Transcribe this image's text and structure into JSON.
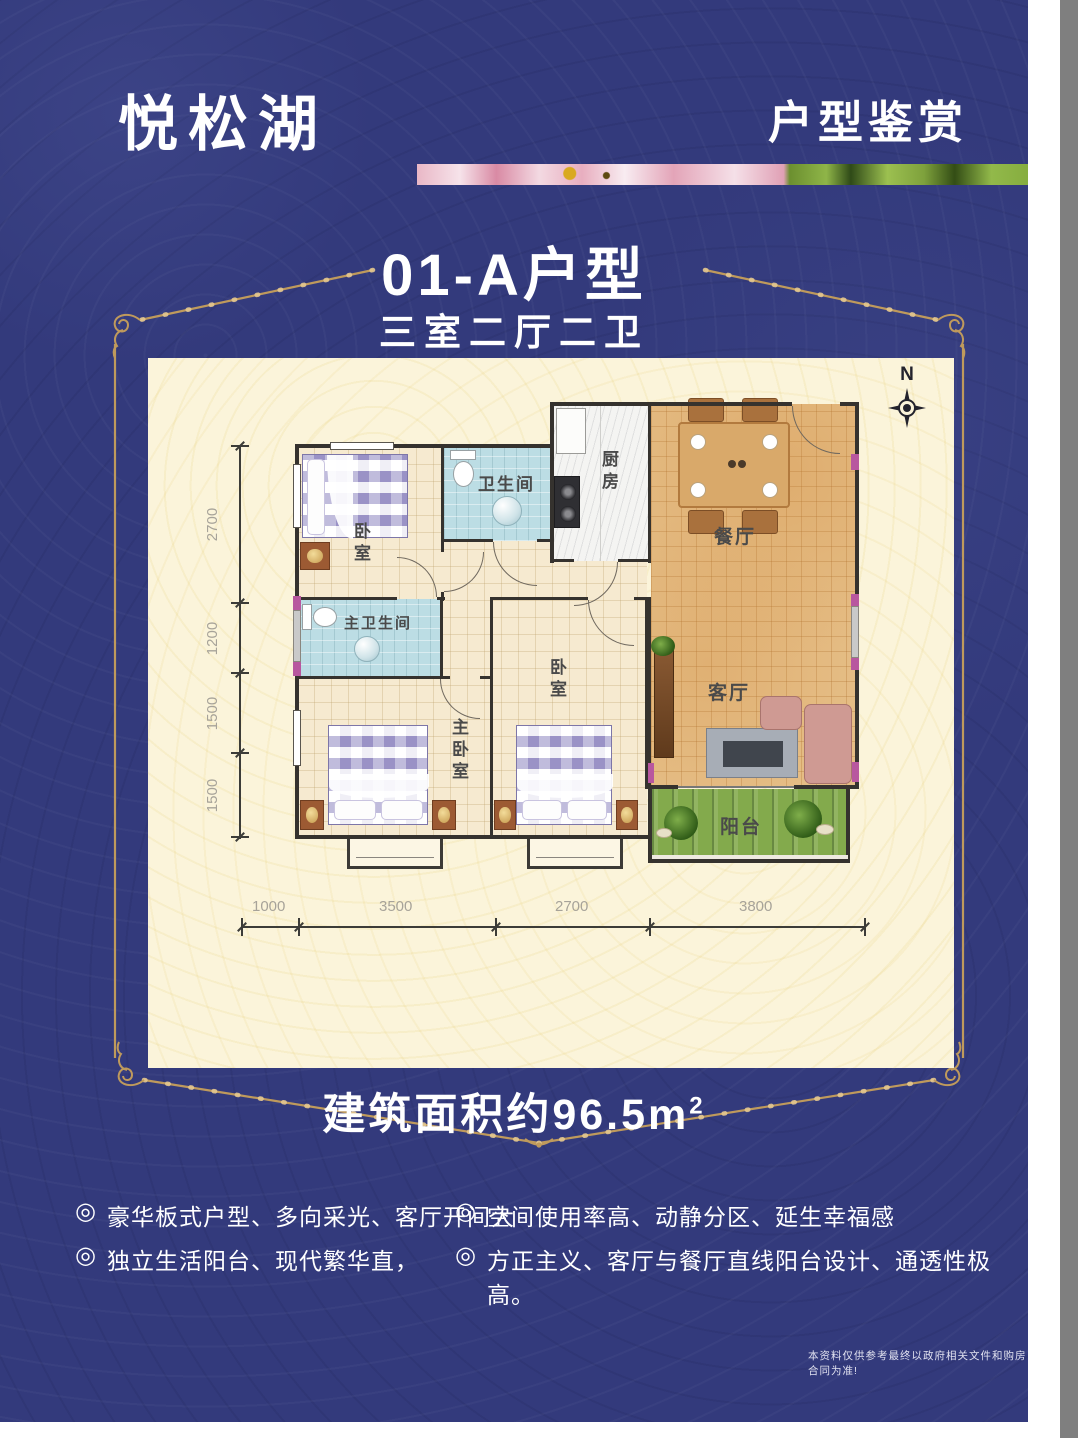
{
  "brand": {
    "logo": "悦松湖"
  },
  "header": {
    "title": "户型鉴赏"
  },
  "unit": {
    "title": "01-A户型",
    "subtitle": "三室二厅二卫"
  },
  "floorplan": {
    "compass_label": "N",
    "rooms": {
      "bedroom1": "卧室",
      "bathroom": "卫生间",
      "kitchen": "厨房",
      "dining": "餐厅",
      "living": "客厅",
      "master_bathroom": "主卫生间",
      "bedroom2": "卧室",
      "master_bedroom": "主卧室",
      "balcony": "阳台"
    },
    "dims_left": [
      "2700",
      "1200",
      "1500",
      "1500"
    ],
    "dims_bottom": [
      "1000",
      "3500",
      "2700",
      "3800"
    ]
  },
  "area": {
    "text": "建筑面积约96.5m",
    "sup": "2"
  },
  "features": {
    "bullet_icon": "◎",
    "left": [
      "豪华板式户型、多向采光、客厅开间大",
      "独立生活阳台、现代繁华直，"
    ],
    "right": [
      "空间使用率高、动静分区、延生幸福感",
      "方正主义、客厅与餐厅直线阳台设计、通透性极高。"
    ]
  },
  "disclaimer": "本资料仅供参考最终以政府相关文件和购房合同为准!",
  "colors": {
    "poster_bg": "#333a7c",
    "gold": "#bf9a5c",
    "panel_bg": "#fbf4da",
    "bath_blue": "#bcdde4",
    "dining_tan": "#e5bd85",
    "balcony_green": "#83aa4c",
    "plaid_purple": "#9a92c6",
    "accent_pink": "#b8579f",
    "wall": "#35322e"
  }
}
